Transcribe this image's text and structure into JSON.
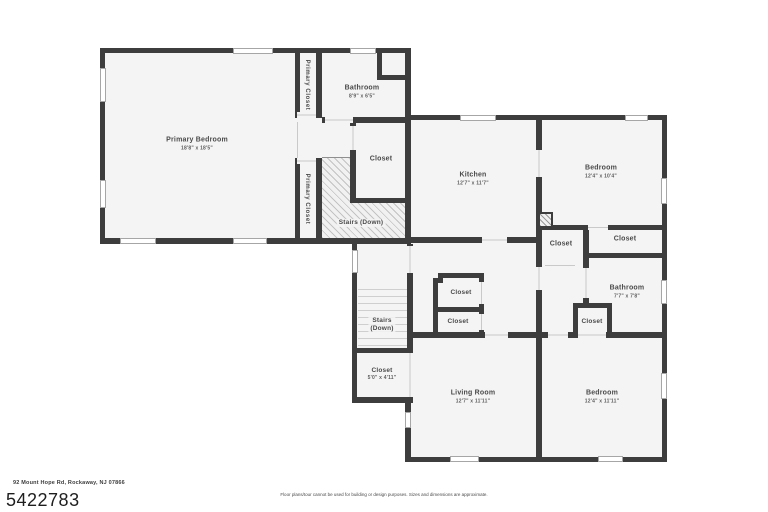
{
  "rooms": {
    "primary_bedroom": {
      "label": "Primary Bedroom",
      "dims": "18'8\" x 18'5\""
    },
    "primary_closet_top": {
      "label": "Primary Closet"
    },
    "primary_closet_bottom": {
      "label": "Primary Closet"
    },
    "bathroom_upper": {
      "label": "Bathroom",
      "dims": "8'9\" x 6'5\""
    },
    "closet_hall": {
      "label": "Closet"
    },
    "stairs_upper": {
      "label": "Stairs (Down)"
    },
    "kitchen": {
      "label": "Kitchen",
      "dims": "12'7\" x 11'7\""
    },
    "bedroom_top": {
      "label": "Bedroom",
      "dims": "12'4\" x 10'4\""
    },
    "closet_bedroom_left": {
      "label": "Closet"
    },
    "closet_bedroom_right": {
      "label": "Closet"
    },
    "bathroom_right": {
      "label": "Bathroom",
      "dims": "7'7\" x 7'8\""
    },
    "closet_bath": {
      "label": "Closet"
    },
    "stairs_lower": {
      "line1": "Stairs",
      "line2": "(Down)"
    },
    "closet_small": {
      "label": "Closet",
      "dims": "5'0\" x 4'11\""
    },
    "closet_mid_upper": {
      "label": "Closet"
    },
    "closet_mid_lower": {
      "label": "Closet"
    },
    "living_room": {
      "label": "Living Room",
      "dims": "12'7\" x 11'11\""
    },
    "bedroom_bottom": {
      "label": "Bedroom",
      "dims": "12'4\" x 11'11\""
    }
  },
  "footer": {
    "address": "92 Mount Hope Rd, Rockaway, NJ 07866",
    "listing_id": "5422783",
    "disclaimer": "Floor plans/tour cannot be used for building or design purposes. Sizes and dimensions are approximate."
  },
  "colors": {
    "wall": "#3d3d3d",
    "floor": "#f4f4f4"
  }
}
